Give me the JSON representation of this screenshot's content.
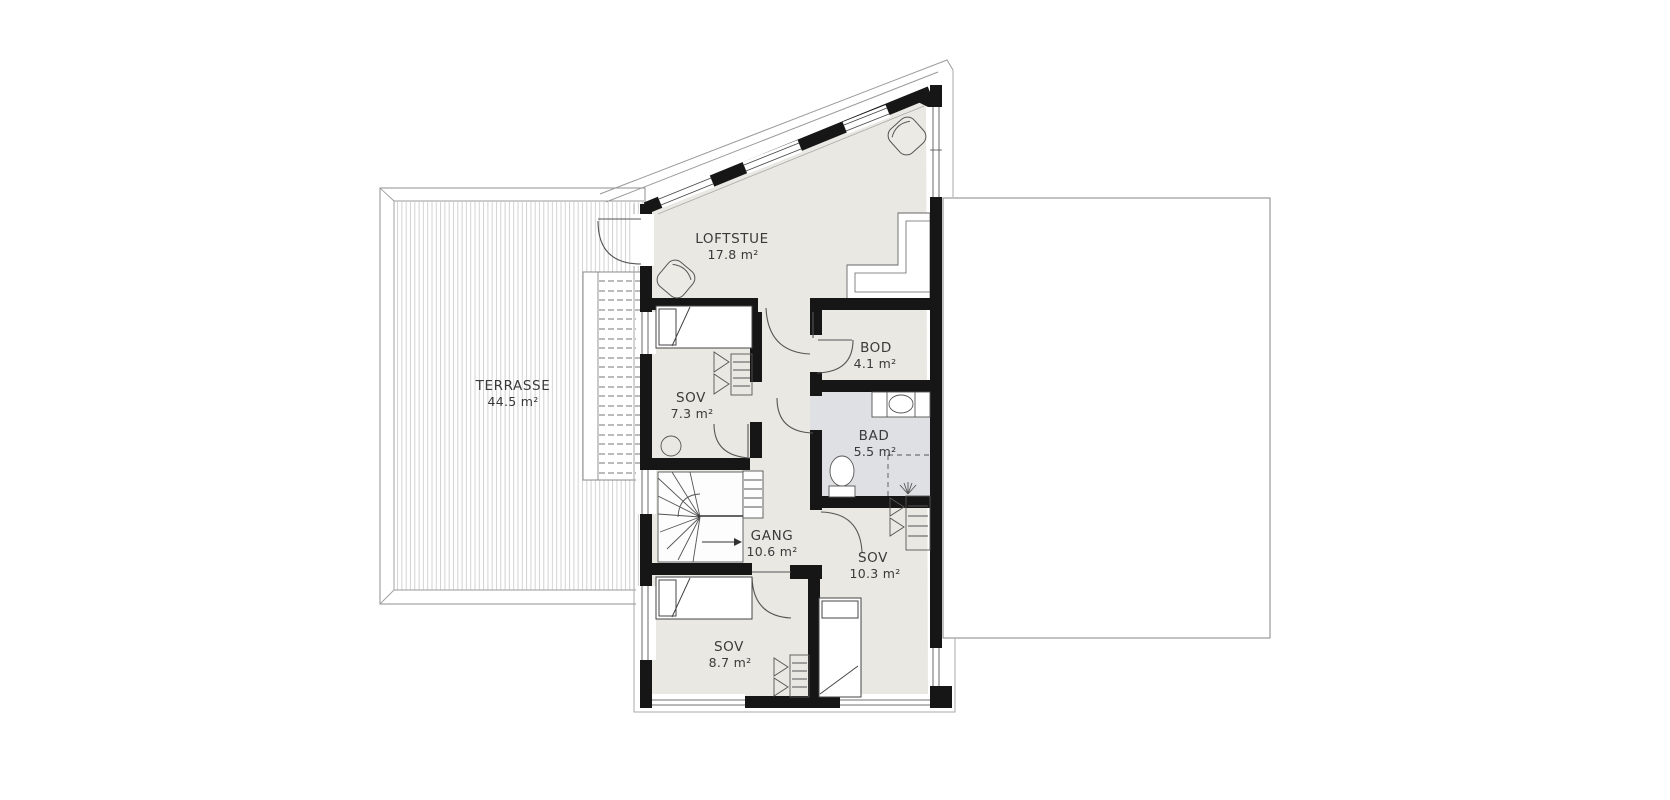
{
  "plan": {
    "type": "floor-plan",
    "floor": "loft / upper floor",
    "rooms": [
      {
        "key": "terrasse",
        "name": "TERRASSE",
        "area": "44.5 m²"
      },
      {
        "key": "loftstue",
        "name": "LOFTSTUE",
        "area": "17.8 m²"
      },
      {
        "key": "sov-7",
        "name": "SOV",
        "area": "7.3 m²"
      },
      {
        "key": "bod",
        "name": "BOD",
        "area": "4.1 m²"
      },
      {
        "key": "bad",
        "name": "BAD",
        "area": "5.5 m²"
      },
      {
        "key": "gang",
        "name": "GANG",
        "area": "10.6 m²"
      },
      {
        "key": "sov-10",
        "name": "SOV",
        "area": "10.3 m²"
      },
      {
        "key": "sov-8",
        "name": "SOV",
        "area": "8.7 m²"
      }
    ],
    "colors": {
      "wall": "#161616",
      "floor": "#e9e8e2",
      "bath_floor": "#dfe0e3",
      "outline": "#999999",
      "deck_stripe": "#cdcdcd",
      "text": "#3a3a3a",
      "background": "#ffffff"
    }
  }
}
